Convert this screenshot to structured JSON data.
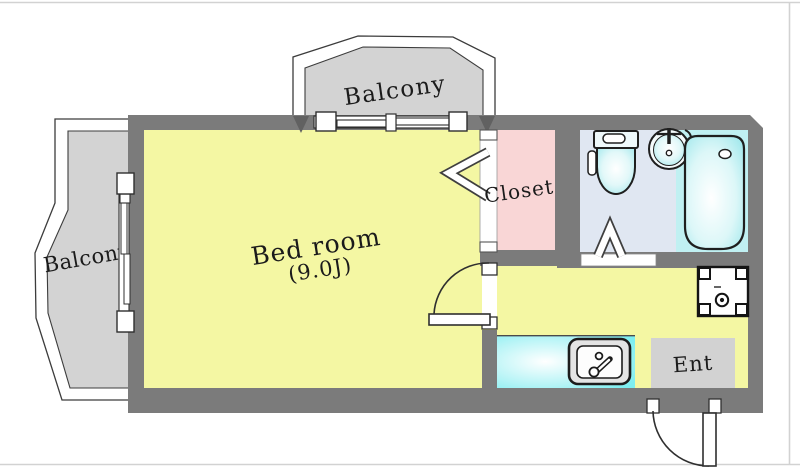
{
  "rooms": {
    "balcony_top": {
      "label": "Balcony"
    },
    "balcony_left": {
      "label": "Balcony"
    },
    "bedroom": {
      "label": "Bed room",
      "size_tatami": "(9.0J)"
    },
    "closet": {
      "label": "Closet"
    },
    "entrance": {
      "label": "Ent"
    }
  },
  "colors": {
    "wall": "#7b7b7b",
    "room_yellow": "#f4f7a3",
    "closet_pink": "#f9d6d6",
    "balcony_gray": "#d3d3d3",
    "bath_floor": "#e0e7f2",
    "bath_wet_zone": "#c0f0f2",
    "kitchen_counter": "#86eff1",
    "entrance_floor": "#d2d2d2",
    "outline": "#2f2f2f"
  },
  "fixtures": [
    "toilet",
    "washbasin",
    "bathtub",
    "kitchen-sink",
    "washing-machine-pan"
  ],
  "openings": [
    "sliding-window-top",
    "sliding-window-left",
    "closet-folding-door",
    "bedroom-swing-door",
    "bathroom-folding-door",
    "entrance-swing-door"
  ]
}
